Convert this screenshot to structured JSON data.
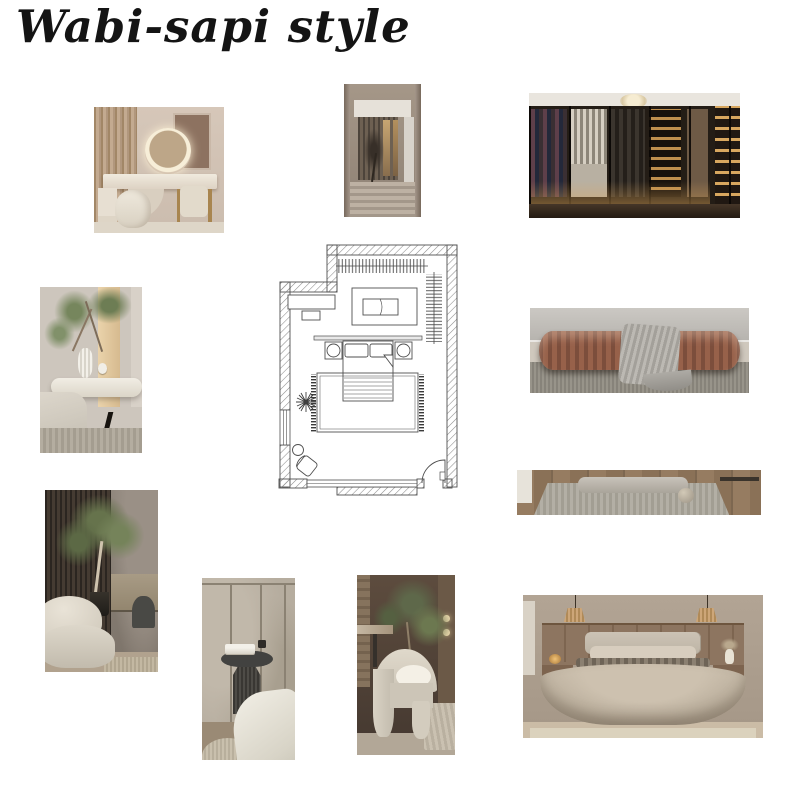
{
  "board": {
    "title": "Wabi-sapi style"
  },
  "palette": {
    "background": "#ffffff",
    "ink": "#141414",
    "plan_line": "#4a4a4a",
    "beige": "#d6c7b9",
    "wood": "#b1977d",
    "dark_wood": "#241d16",
    "amber_glow": "#bf8f4e",
    "terracotta": "#8a5340",
    "olive_green": "#66734c",
    "cream": "#e0d9cb",
    "stone": "#b6ad9f",
    "charcoal": "#424240"
  },
  "images": {
    "vanity": {
      "name": "vanity-dressing-table",
      "description": "Beige dressing table with round backlit mirror, quilted pouf and brass legs"
    },
    "doorway": {
      "name": "taupe-hallway-portal",
      "description": "Taupe hallway portal with bronze slats and dried branch arrangement"
    },
    "closet": {
      "name": "walk-in-wardrobe",
      "description": "Dark glass walk-in wardrobe with warm LED shelf lighting and chandelier"
    },
    "nightstand": {
      "name": "floating-nightstand",
      "description": "White floating nightstand with ribbed vase and green branches"
    },
    "bench": {
      "name": "terracotta-bench",
      "description": "Ribbed terracotta bed-end bench with grey throw on woven rug"
    },
    "platform": {
      "name": "floor-bolster",
      "description": "Long grey bolster cushion and ball pillow on textured rug beside wooden bench"
    },
    "olive_tree": {
      "name": "olive-tree-corner",
      "description": "Indoor olive tree against dark slatted wall with cream pebble lounge chair"
    },
    "side_table": {
      "name": "fluted-side-table",
      "description": "Charcoal fluted pedestal side table with books against stone panels"
    },
    "chair": {
      "name": "sculptural-armchair",
      "description": "Cream sculptural curved armchair with olive tree backdrop"
    },
    "bed": {
      "name": "linen-bed",
      "description": "Bed with taupe linen bedding, wood panel headboard, rattan pendants and nightstands"
    }
  },
  "floorplan": {
    "name": "bedroom-floor-plan",
    "description": "Bedroom floor plan with walk-in closet, dresser, double bed with nightstands, fringed rug, plant, reading chair, window and entry door"
  }
}
